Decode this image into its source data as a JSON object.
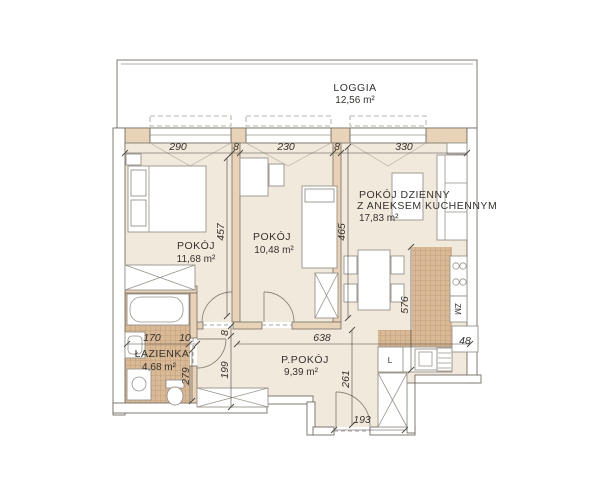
{
  "loggia": {
    "label": "LOGGIA",
    "area": "12,56 m²"
  },
  "rooms": {
    "room1": {
      "label": "POKÓJ",
      "area": "11,68 m²"
    },
    "room2": {
      "label": "POKÓJ",
      "area": "10,48 m²"
    },
    "living": {
      "line1": "POKÓJ DZIENNY",
      "line2": "Z ANEKSEM KUCHENNYM",
      "area": "17,83 m²"
    },
    "bathroom": {
      "label": "ŁAZIENKA",
      "area": "4,68 m²"
    },
    "hallway": {
      "label": "P.POKÓJ",
      "area": "9,39 m²"
    }
  },
  "dims": {
    "room1_width": "290",
    "wall_a": "8",
    "room2_width": "230",
    "wall_b": "8",
    "living_width": "330",
    "room1_depth": "457",
    "room2_depth": "465",
    "kitchen_wall": "576",
    "bath_width": "170",
    "bath_nib": "10",
    "bath_depth": "279",
    "hall_wall_thk": "8",
    "hall_nook": "199",
    "hall_length": "638",
    "entry_depth": "261",
    "entry_width": "193",
    "counter": "48"
  },
  "appliances": {
    "dishwasher": "ZM",
    "fridge": "L"
  },
  "colors": {
    "interior_wall": "#e8d2b8",
    "room_floor": "#f2e9dd",
    "tile_floor": "#d9b996",
    "tile_grid": "#b08c66",
    "outline": "#736d63",
    "dim_text": "#34322e"
  }
}
